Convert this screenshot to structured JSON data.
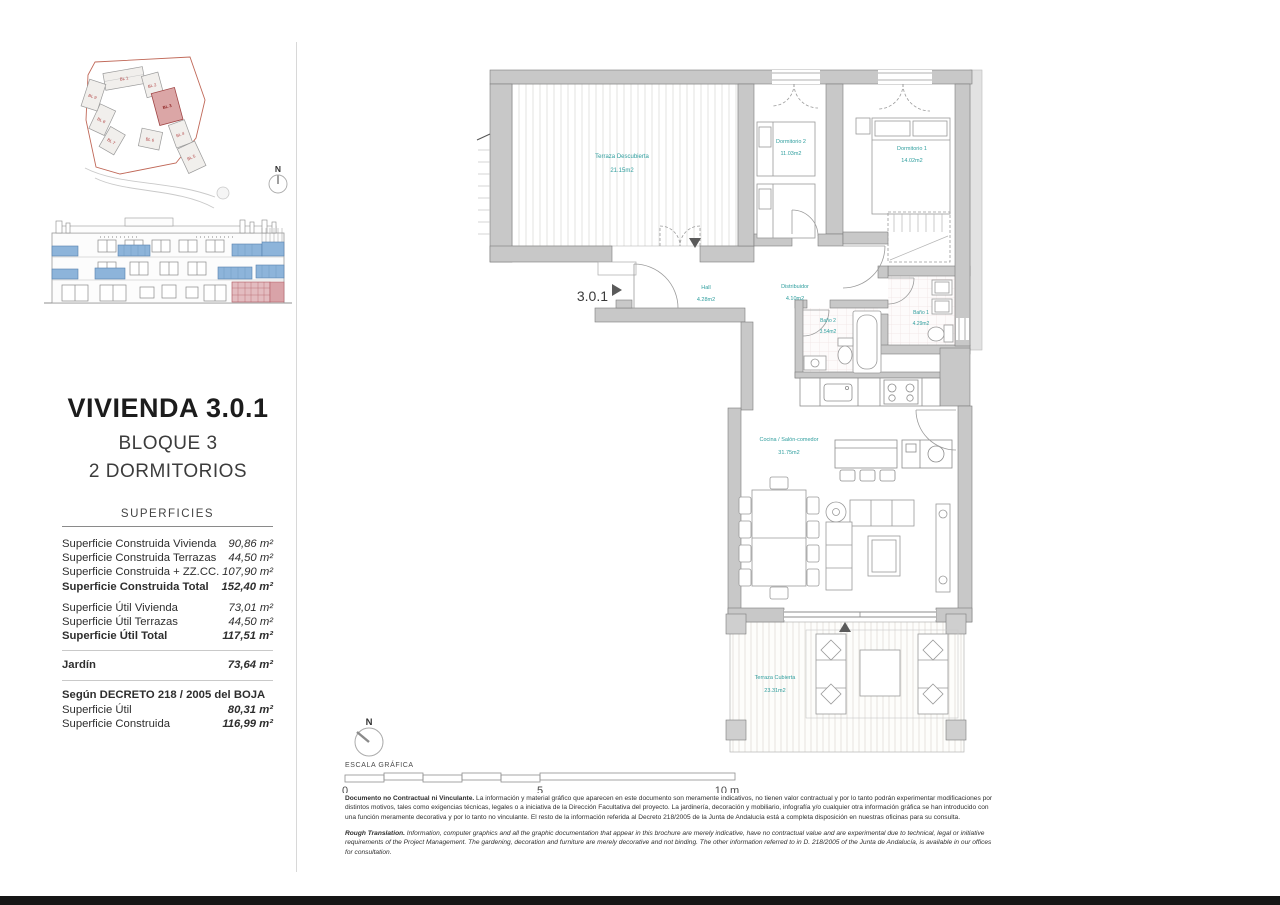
{
  "colors": {
    "teal": "#2f9e9e",
    "wall": "#c8c8c8",
    "highlight_pink": "#dfb3b8",
    "balcony_blue": "#8db4da",
    "label_red": "#b04040"
  },
  "sidebar": {
    "site_plan": {
      "north_label": "N",
      "blocks": [
        "BL 1",
        "BL 2",
        "BL 3",
        "BL 4",
        "BL 5",
        "BL 6",
        "BL 7",
        "BL 8",
        "BL 9"
      ]
    },
    "title": "VIVIENDA 3.0.1",
    "block": "BLOQUE 3",
    "bedrooms": "2 DORMITORIOS",
    "superficies": {
      "heading": "SUPERFICIES",
      "construida": [
        {
          "label": "Superficie Construida Vivienda",
          "value": "90,86 m²"
        },
        {
          "label": "Superficie Construida Terrazas",
          "value": "44,50 m²"
        },
        {
          "label": "Superficie Construida + ZZ.CC.",
          "value": "107,90 m²"
        },
        {
          "label": "Superficie Construida Total",
          "value": "152,40 m²"
        }
      ],
      "util": [
        {
          "label": "Superficie Útil Vivienda",
          "value": "73,01 m²"
        },
        {
          "label": "Superficie Útil Terrazas",
          "value": "44,50 m²"
        },
        {
          "label": "Superficie Útil Total",
          "value": "117,51 m²"
        }
      ],
      "jardin": {
        "label": "Jardín",
        "value": "73,64 m²"
      },
      "decreto_heading": "Según DECRETO 218 / 2005 del BOJA",
      "decreto": [
        {
          "label": "Superficie Útil",
          "value": "80,31 m²"
        },
        {
          "label": "Superficie Construida",
          "value": "116,99 m²"
        }
      ]
    }
  },
  "plan": {
    "unit_label": "3.0.1",
    "north_label": "N",
    "rooms": [
      {
        "name": "Terraza Descubierta",
        "area": "21.15m2"
      },
      {
        "name": "Dormitorio 2",
        "area": "11.03m2"
      },
      {
        "name": "Dormitorio 1",
        "area": "14.02m2"
      },
      {
        "name": "Hall",
        "area": "4.28m2"
      },
      {
        "name": "Distribuidor",
        "area": "4.10m2"
      },
      {
        "name": "Baño 2",
        "area": "3.54m2"
      },
      {
        "name": "Baño 1",
        "area": "4.29m2"
      },
      {
        "name": "Cocina / Salón-comedor",
        "area": "31.75m2"
      },
      {
        "name": "Terraza Cubierta",
        "area": "23.31m2"
      }
    ],
    "scale": {
      "label": "ESCALA GRÁFICA",
      "tick0": "0",
      "tick5": "5",
      "tick10": "10 m"
    }
  },
  "footer": {
    "es_lead": "Documento no Contractual ni Vinculante.",
    "es_body": " La información y material gráfico que aparecen en este documento son meramente indicativos, no tienen valor contractual y por lo tanto podrán experimentar modificaciones por distintos motivos, tales como exigencias técnicas, legales o a iniciativa de la Dirección Facultativa del proyecto. La jardinería, decoración y mobiliario, infografía y/o cualquier otra información gráfica se han introducido con una función meramente decorativa y por lo tanto no vinculante. El resto de la información referida al Decreto 218/2005 de la Junta de Andalucía está a completa disposición en nuestras oficinas para su consulta.",
    "en_lead": "Rough Translation.",
    "en_body": " Information, computer graphics and all the graphic documentation that appear in this brochure are merely indicative, have no contractual value and are experimental due to technical, legal or initiative requirements of the Project Management. The gardening, decoration and furniture are merely decorative and not binding. The other information referred to in D. 218/2005 of the Junta de Andalucía, is available in our offices for consultation."
  }
}
